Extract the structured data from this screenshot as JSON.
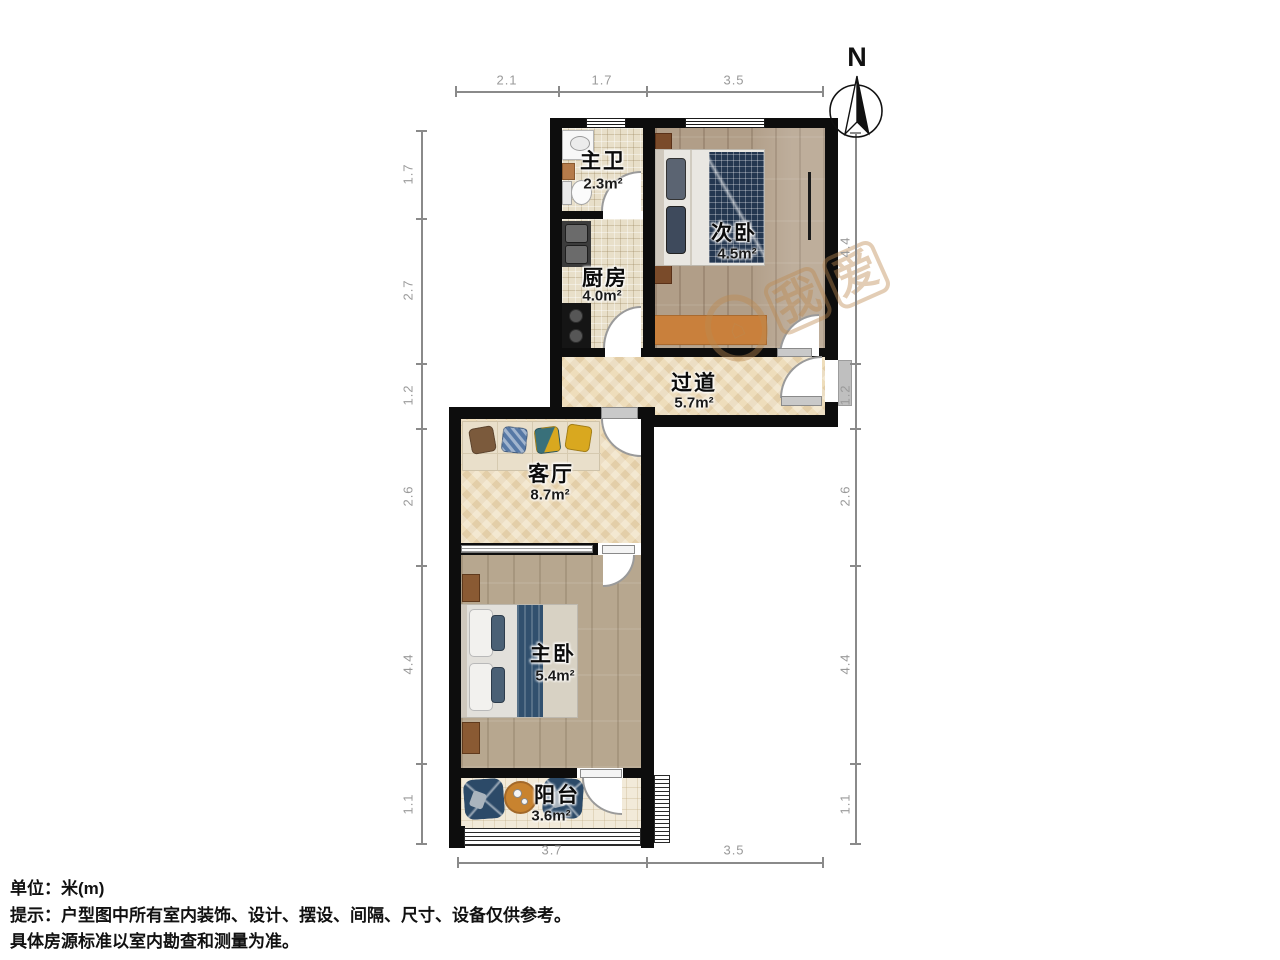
{
  "rooms": [
    {
      "id": "master-bath",
      "name": "主卫",
      "area": "2.3m²"
    },
    {
      "id": "kitchen",
      "name": "厨房",
      "area": "4.0m²"
    },
    {
      "id": "second-bedroom",
      "name": "次卧",
      "area": "4.5m²"
    },
    {
      "id": "hallway",
      "name": "过道",
      "area": "5.7m²"
    },
    {
      "id": "living-room",
      "name": "客厅",
      "area": "8.7m²"
    },
    {
      "id": "master-bedroom",
      "name": "主卧",
      "area": "5.4m²"
    },
    {
      "id": "balcony",
      "name": "阳台",
      "area": "3.6m²"
    }
  ],
  "dimensions": {
    "top": [
      "2.1",
      "1.7",
      "3.5"
    ],
    "bottom": [
      "3.7",
      "3.5"
    ],
    "left": [
      "1.7",
      "2.7",
      "1.2",
      "2.6",
      "4.4",
      "1.1"
    ],
    "right": [
      "4.4",
      "1.2",
      "2.6",
      "4.4",
      "1.1"
    ]
  },
  "compass": {
    "label": "N"
  },
  "watermark": {
    "char1": "我",
    "char2": "爱",
    "house_glyph": "⌂"
  },
  "footer": {
    "line1": "单位：米(m)",
    "line2": "提示：户型图中所有室内装饰、设计、摆设、间隔、尺寸、设备仅供参考。",
    "line3": "具体房源标准以室内勘查和测量为准。"
  },
  "colors": {
    "wall": "#0d0d0d",
    "tile": "#e8dfc9",
    "herringbone": "#eeddbb",
    "wood": "#b19e88",
    "rug_orange": "#c9803c",
    "navy_furniture": "#2c4a68",
    "table_orange": "#c8832f",
    "entry_pad_gray": "#bfbfbf",
    "watermark_tan": "#bd8a50"
  }
}
